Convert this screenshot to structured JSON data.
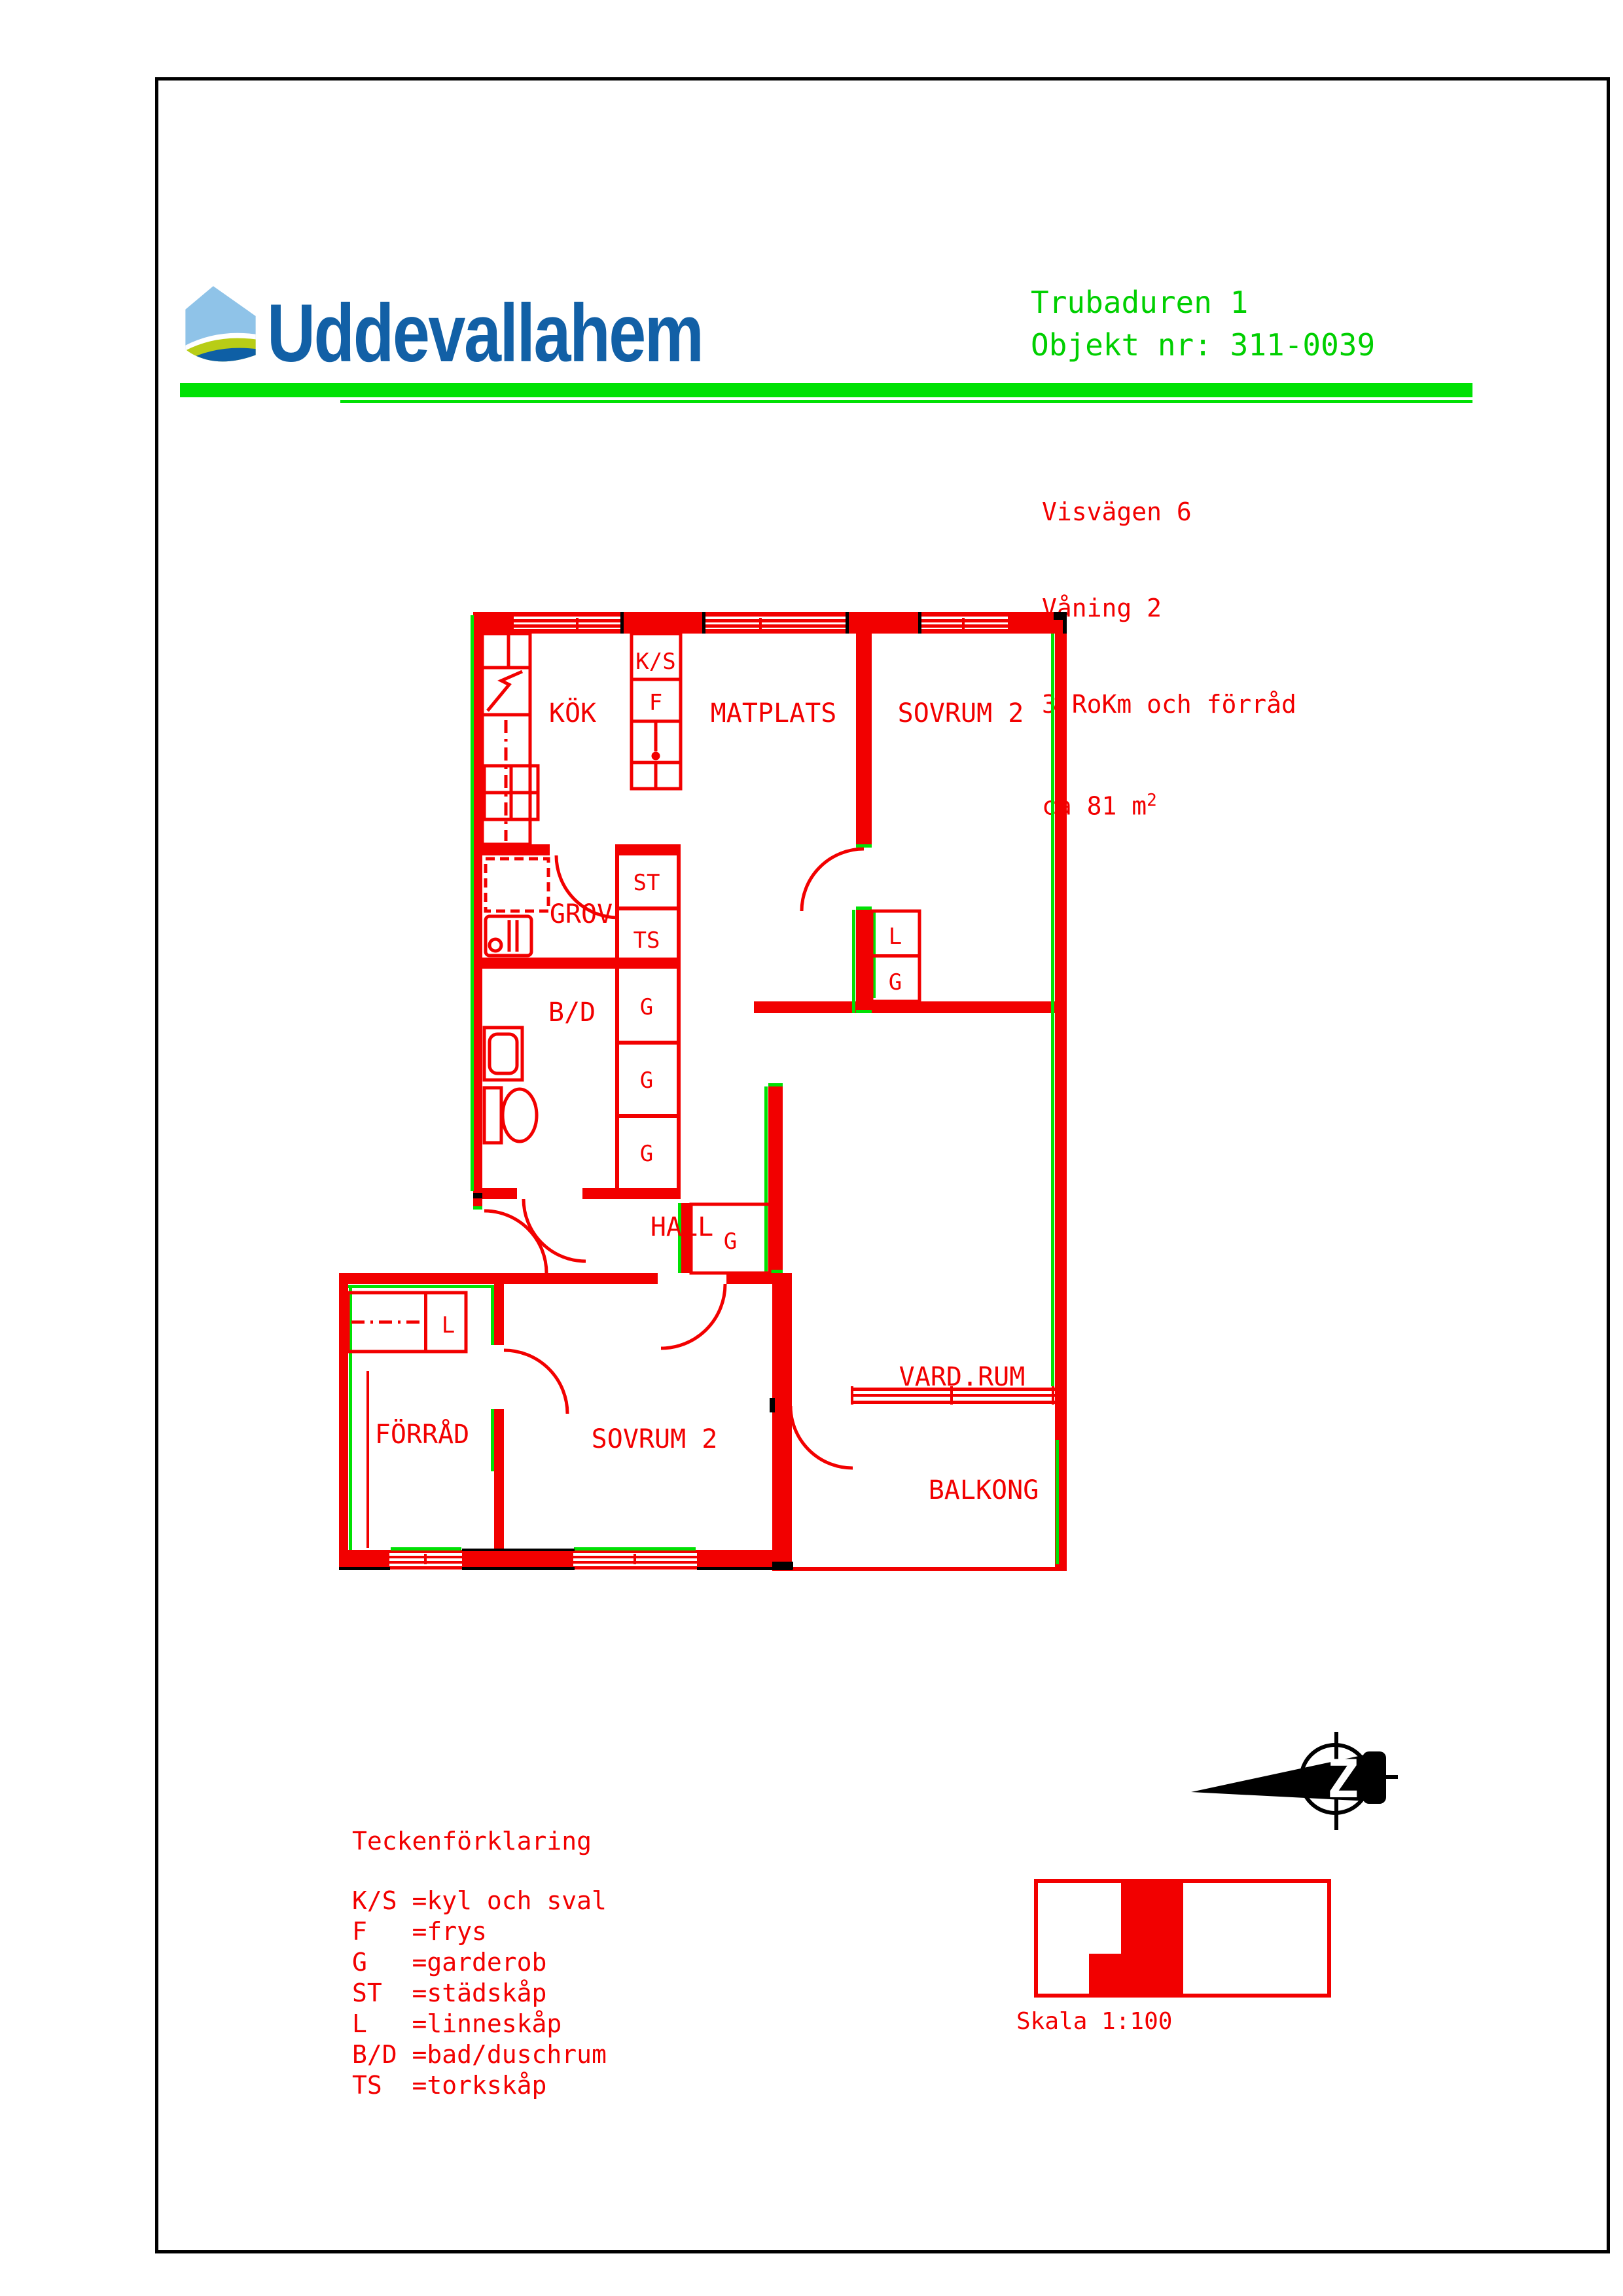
{
  "header": {
    "brand": "Uddevallahem",
    "project": "Trubaduren 1",
    "object_no": "Objekt nr: 311-0039"
  },
  "info": {
    "address": "Visvägen 6",
    "floor": "Våning 2",
    "layout": "3 RoKm och förråd",
    "area": "ca 81 m",
    "area_exp": "2"
  },
  "plan": {
    "rooms": {
      "kok": "KÖK",
      "matplats": "MATPLATS",
      "sovrum2_upper": "SOVRUM 2",
      "grov": "GROV",
      "bd": "B/D",
      "hall": "HALL",
      "forrad": "FÖRRÅD",
      "sovrum2_lower": "SOVRUM 2",
      "vardrum": "VARD.RUM",
      "balkong": "BALKONG"
    },
    "closets": {
      "ks": "K/S",
      "f": "F",
      "st": "ST",
      "ts": "TS",
      "g1": "G",
      "g2": "G",
      "g3": "G",
      "l_sovrum": "L",
      "g_sovrum": "G",
      "g_hall": "G",
      "l_forrad": "L"
    },
    "compass_letter": "Z"
  },
  "legend": {
    "title": "Teckenförklaring",
    "items": [
      {
        "abbr": "K/S",
        "desc": "=kyl och sval"
      },
      {
        "abbr": "F",
        "desc": "=frys"
      },
      {
        "abbr": "G",
        "desc": "=garderob"
      },
      {
        "abbr": "ST",
        "desc": "=städskåp"
      },
      {
        "abbr": "L",
        "desc": "=linneskåp"
      },
      {
        "abbr": "B/D",
        "desc": "=bad/duschrum"
      },
      {
        "abbr": "TS",
        "desc": "=torkskåp"
      }
    ]
  },
  "scale": {
    "label": "Skala 1:100"
  },
  "colors": {
    "red": "#F20000",
    "green": "#00E104",
    "title_green": "#00CF00",
    "logo_blue_dark": "#1260A6",
    "logo_blue_light": "#8FC3E8",
    "logo_lime": "#B8CD16",
    "black": "#000000"
  }
}
